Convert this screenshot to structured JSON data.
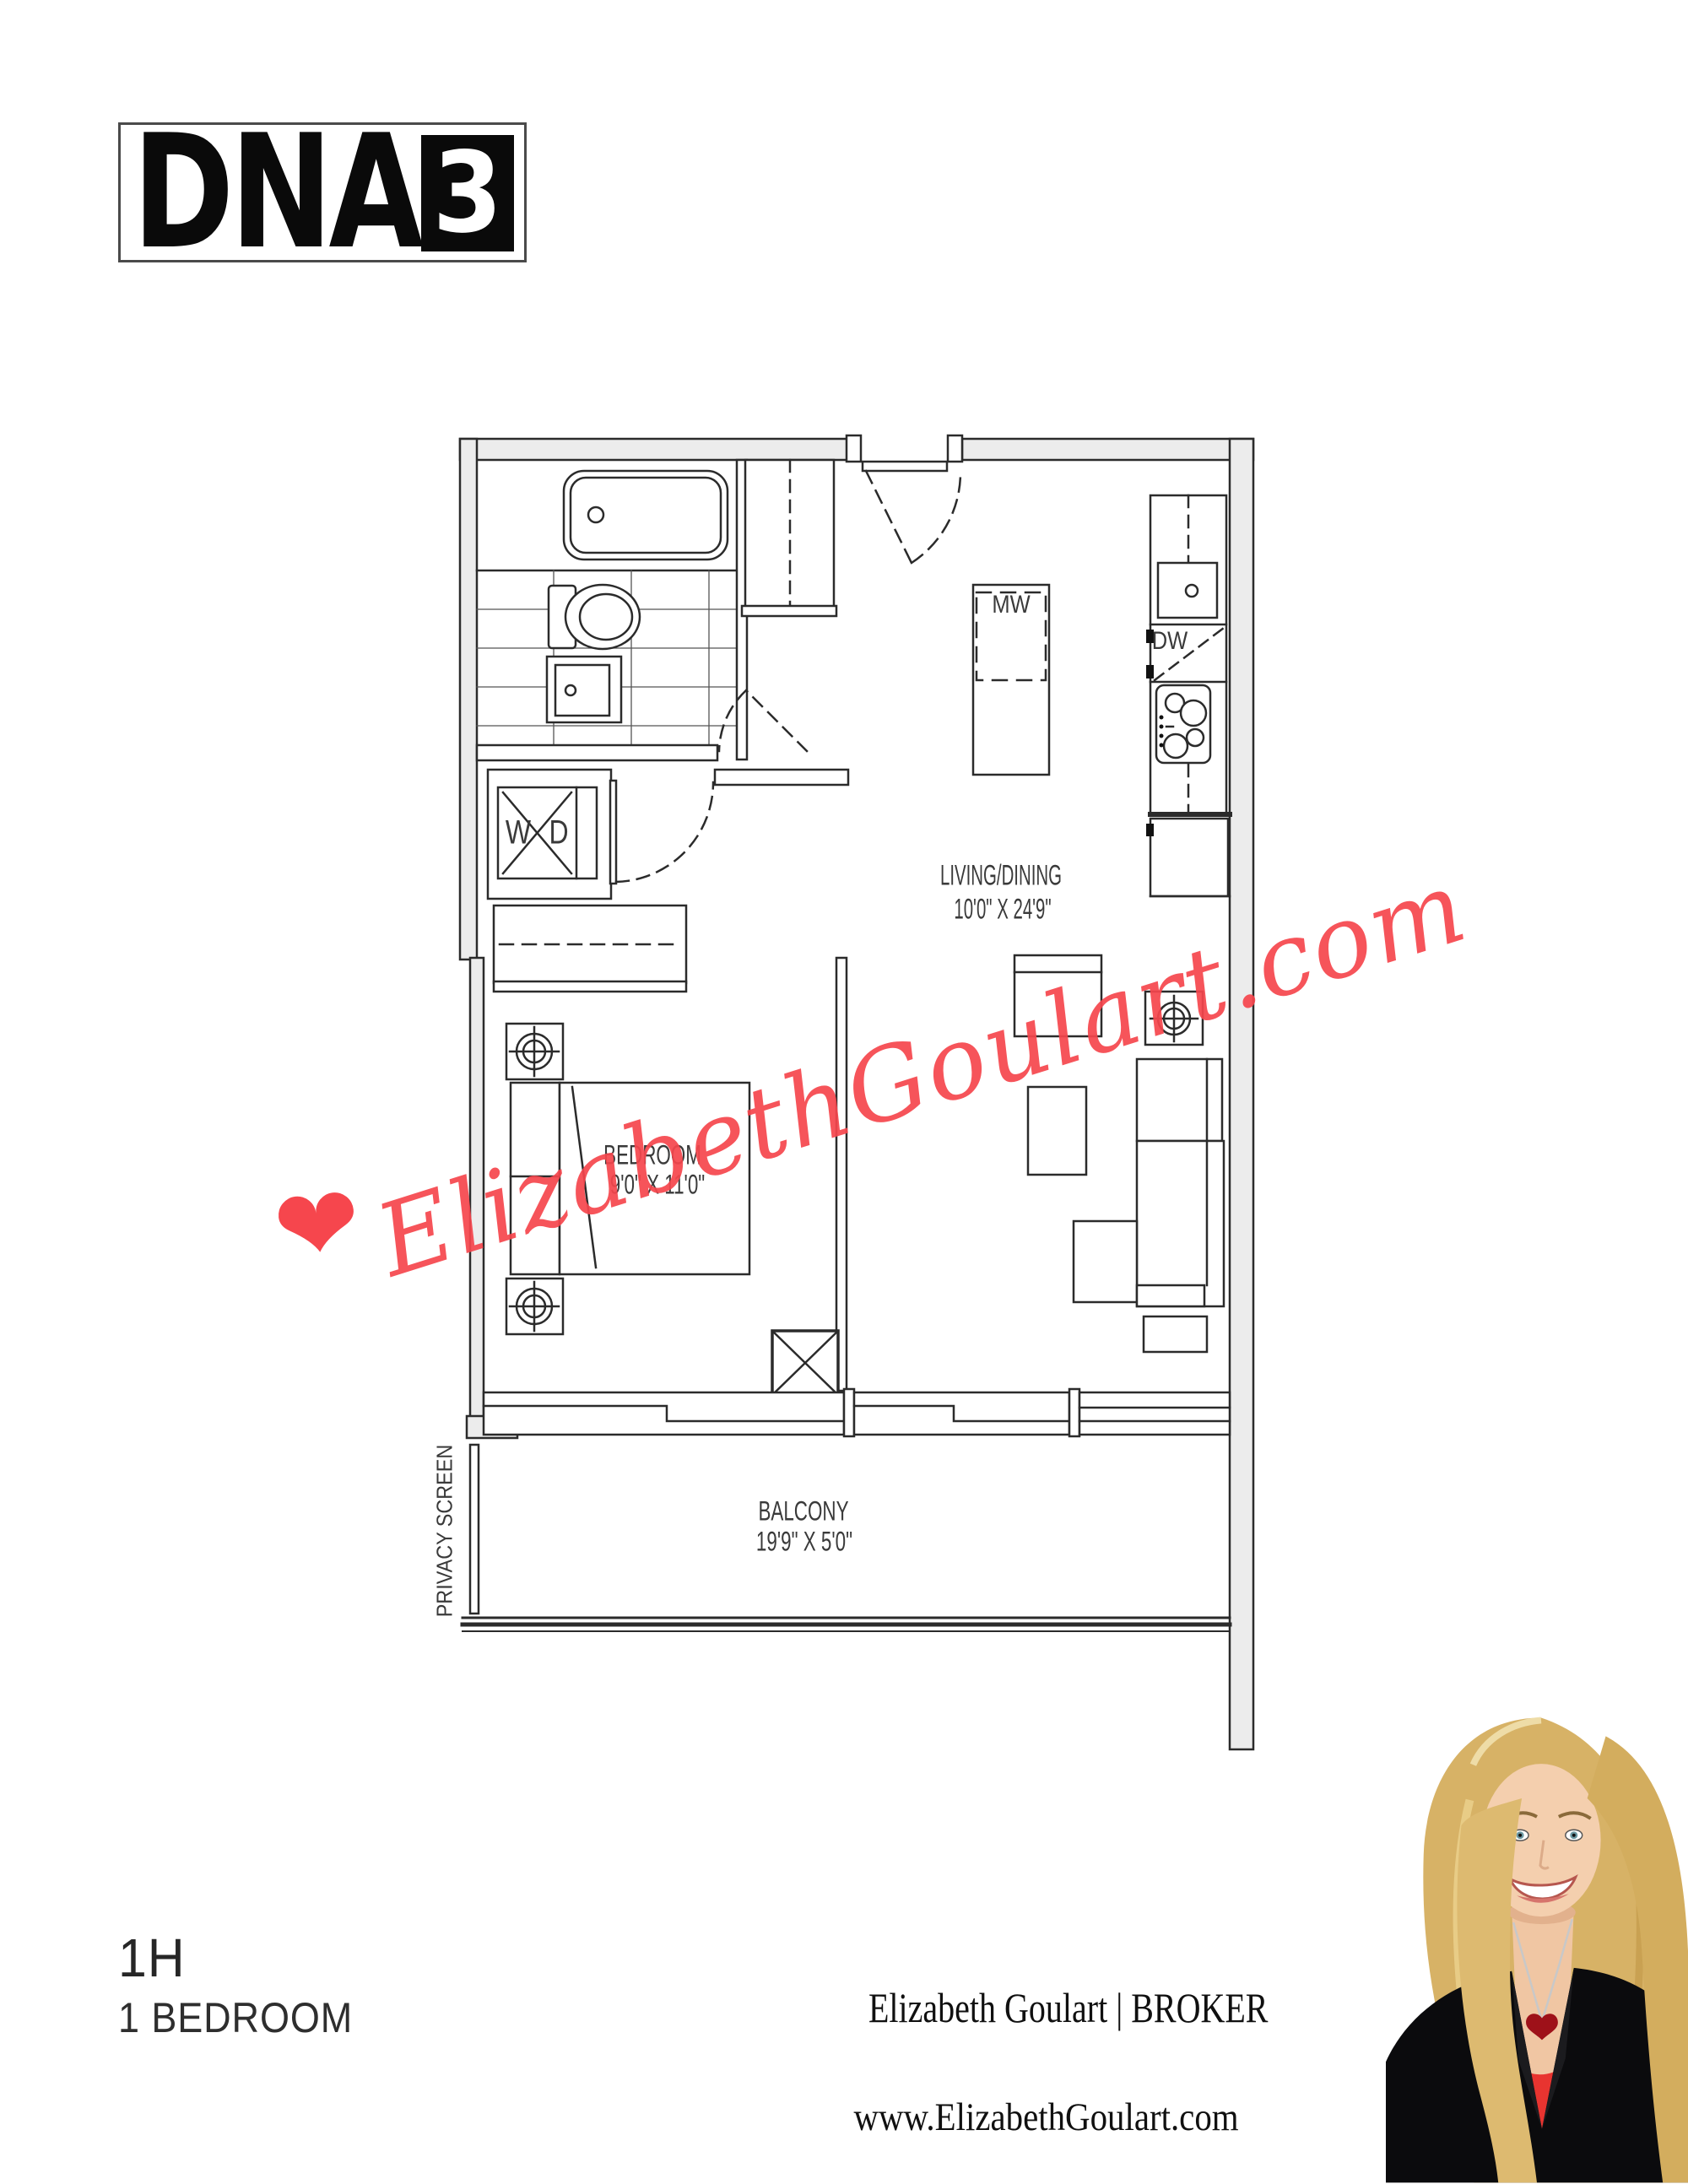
{
  "logo": {
    "name": "DNA",
    "number": "3"
  },
  "floor_plan": {
    "living": {
      "label": "LIVING/DINING",
      "dimensions": "10'0\" X 24'9\""
    },
    "bedroom": {
      "label": "BEDROOM",
      "dimensions": "9'0\" X 11'0\""
    },
    "balcony": {
      "label": "BALCONY",
      "dimensions": "19'9\" X 5'0\""
    },
    "privacy_screen": "PRIVACY SCREEN",
    "appliances": {
      "microwave": "MW",
      "dishwasher": "DW",
      "washer": "W",
      "dryer": "D"
    }
  },
  "watermark": {
    "heart": "❤",
    "text": "ElizabethGoulart.com",
    "color": "#f6464d"
  },
  "footer": {
    "unit_code": "1H",
    "unit_type": "1 BEDROOM",
    "agent": "Elizabeth Goulart | BROKER",
    "website": "www.ElizabethGoulart.com"
  }
}
